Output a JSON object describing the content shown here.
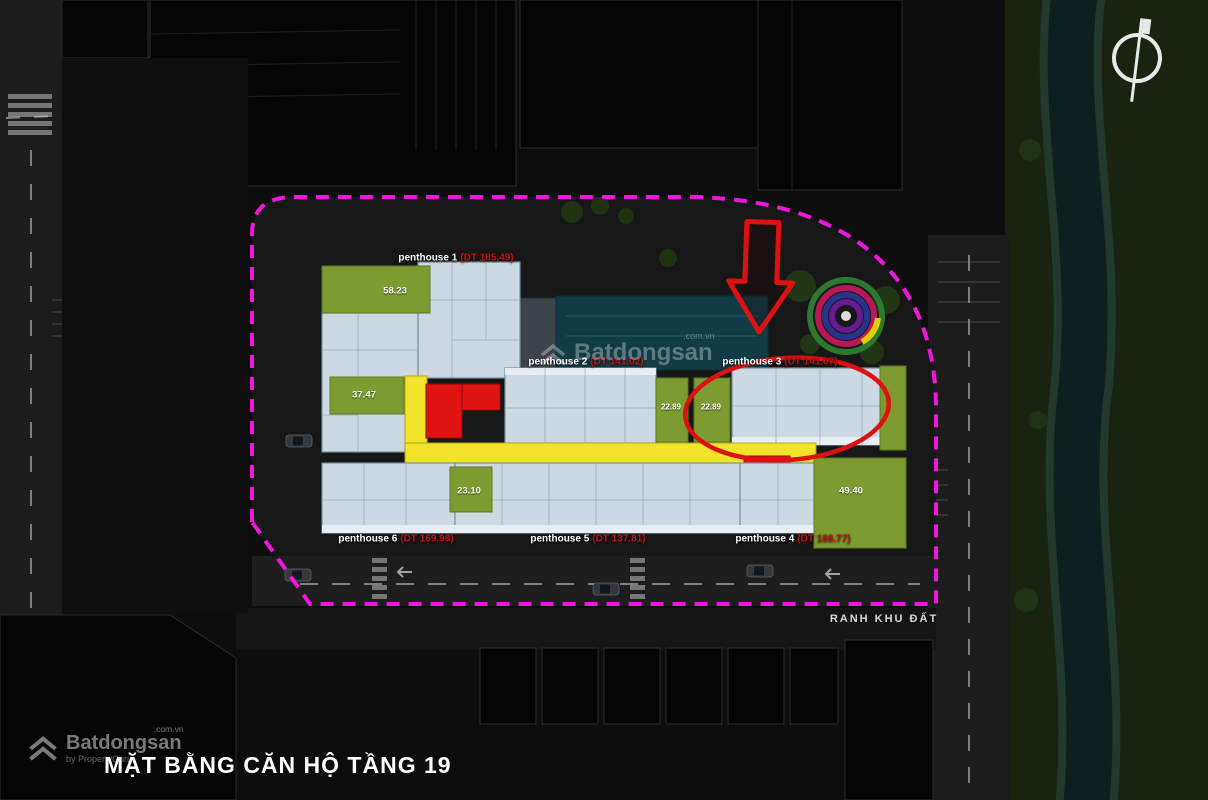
{
  "header": {
    "title": "MẶT BẰNG CĂN HỘ TẦNG 19"
  },
  "boundary": {
    "label": "RANH KHU ĐẤT"
  },
  "brand": {
    "name": "Batdongsan",
    "domain": ".com.vn",
    "tagline": "by PropertyGuru"
  },
  "watermark": {
    "name": "Batdongsan",
    "domain": ".com.vn"
  },
  "units": [
    {
      "name": "penthouse 1",
      "area_label": "(DT 185.49)"
    },
    {
      "name": "penthouse 2",
      "area_label": "(DT 141.02)"
    },
    {
      "name": "penthouse 3",
      "area_label": "(DT 141.07)"
    },
    {
      "name": "penthouse 4",
      "area_label": "(DT 188.77)"
    },
    {
      "name": "penthouse 5",
      "area_label": "(DT 137.81)"
    },
    {
      "name": "penthouse 6",
      "area_label": "(DT 169.98)"
    }
  ],
  "garden_areas": [
    {
      "value": "58.23"
    },
    {
      "value": "37.47"
    },
    {
      "value": "23.10"
    },
    {
      "value": "22.89"
    },
    {
      "value": "22.89"
    },
    {
      "value": "49.40"
    }
  ],
  "colors": {
    "boundary_magenta": "#f116dd",
    "highlight_red": "#dd1111",
    "corridor_yellow": "#f2e32b",
    "garden_green": "#7d9b31",
    "unit_blue": "#cdd9e2",
    "area_text_red": "#c41111"
  }
}
